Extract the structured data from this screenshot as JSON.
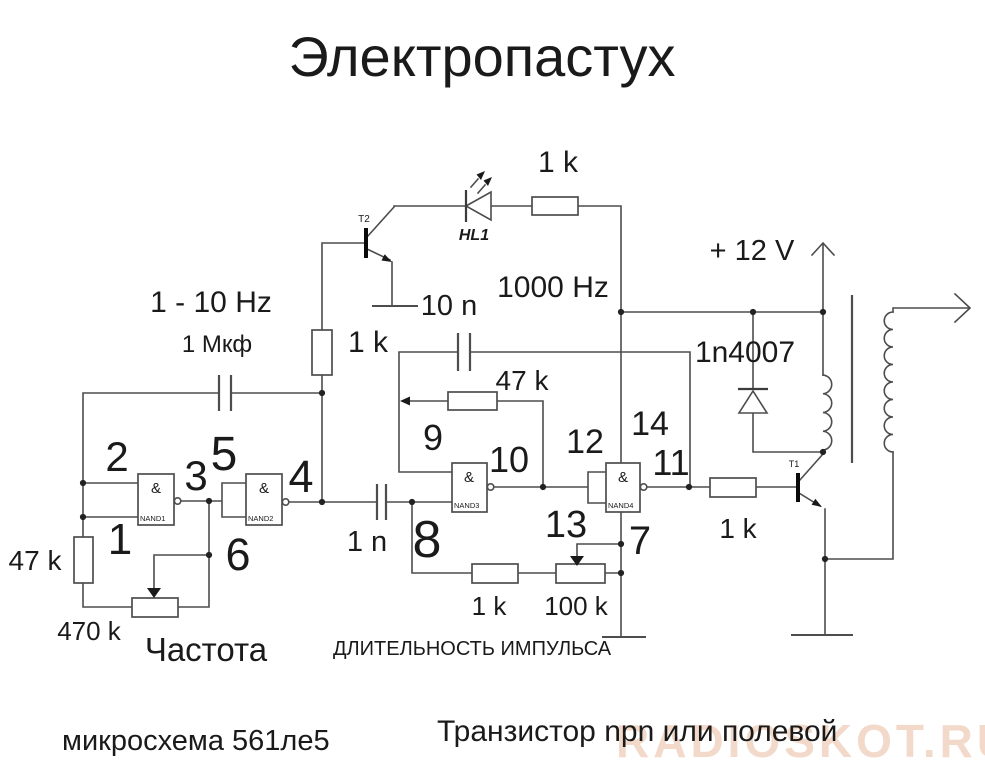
{
  "title": "Электропастух",
  "watermark": "RADIOSKOT.RU",
  "colors": {
    "background": "#ffffff",
    "wire": "#4d4d4d",
    "text": "#1a1a1a",
    "watermark": "#f2d9ca"
  },
  "notes": {
    "chip": "микросхема 561ле5",
    "transistor": "Транзистор npn или полевой"
  },
  "labels": {
    "r_led": "1 k",
    "freq_range": "1 - 10 Hz",
    "c1": "1 Мкф",
    "r_base2": "1 k",
    "c2": "10 n",
    "freq_out": "1000 Hz",
    "supply": "+ 12 V",
    "diode": "1n4007",
    "r_fb": "47 k",
    "led": "HL1",
    "t2": "T2",
    "t1": "T1",
    "r_base1": "1 k",
    "r_left": "47 k",
    "pot_freq": "470 k",
    "freq_caption": "Частота",
    "c3": "1 n",
    "r_pulse": "1 k",
    "pot_pulse": "100 k",
    "pulse_caption": "ДЛИТЕЛЬНОСТЬ ИМПУЛЬСА"
  },
  "gates": {
    "nand1": {
      "symbol": "&",
      "name": "NAND1"
    },
    "nand2": {
      "symbol": "&",
      "name": "NAND2"
    },
    "nand3": {
      "symbol": "&",
      "name": "NAND3"
    },
    "nand4": {
      "symbol": "&",
      "name": "NAND4"
    }
  },
  "pins": {
    "p1": "1",
    "p2": "2",
    "p3": "3",
    "p4": "4",
    "p5": "5",
    "p6": "6",
    "p7": "7",
    "p8": "8",
    "p9": "9",
    "p10": "10",
    "p11": "11",
    "p12": "12",
    "p13": "13",
    "p14": "14"
  }
}
